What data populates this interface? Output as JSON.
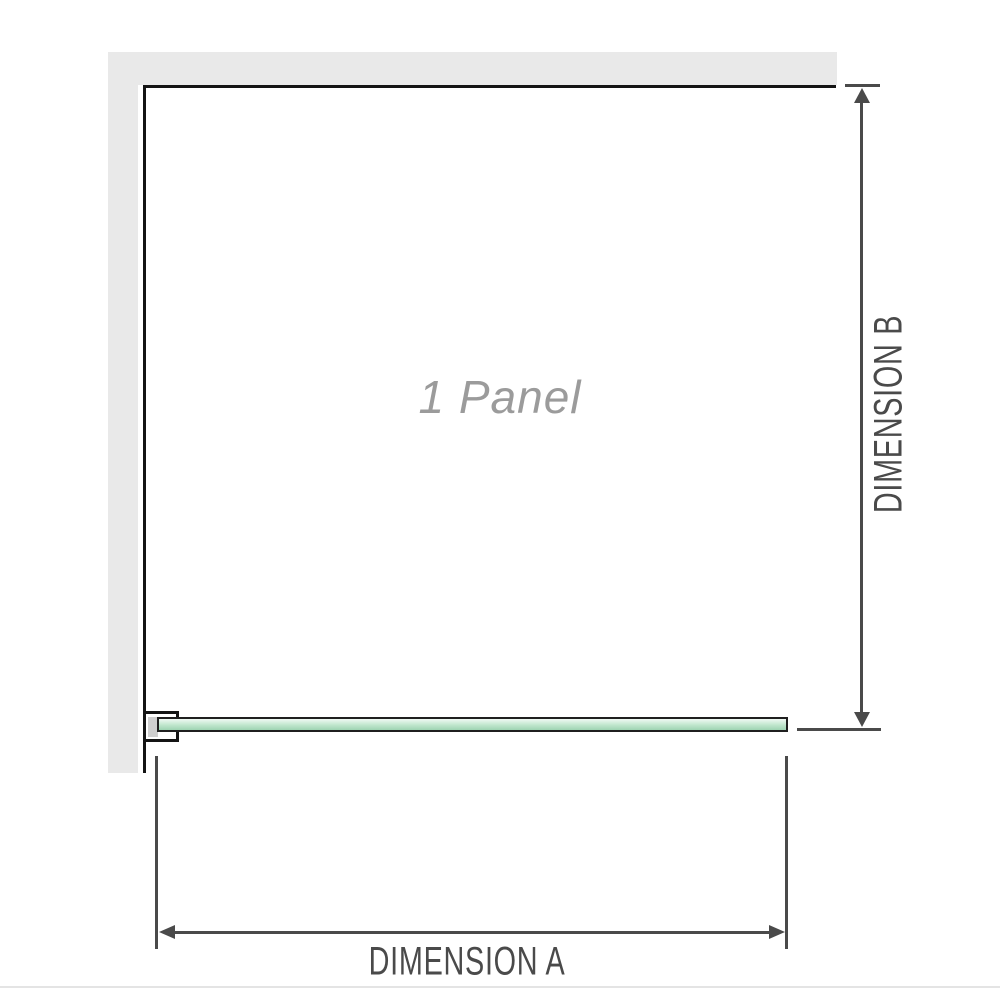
{
  "diagram": {
    "panel_label": "1 Panel",
    "dimension_a_label": "DIMENSION A",
    "dimension_b_label": "DIMENSION B"
  },
  "colors": {
    "wall": "#e9e9e9",
    "panel_outline": "#141414",
    "glass_border": "#1f1f1f",
    "glass_gradient_top": "#f0f9f3",
    "glass_gradient_mid": "#bfe6cd",
    "glass_gradient_bottom": "#9ed3b2",
    "bracket_pad": "#cfcfcf",
    "dimension_lines": "#4a4a4a",
    "panel_label_text": "#9b9b9b",
    "separator": "#e4e4e4"
  }
}
